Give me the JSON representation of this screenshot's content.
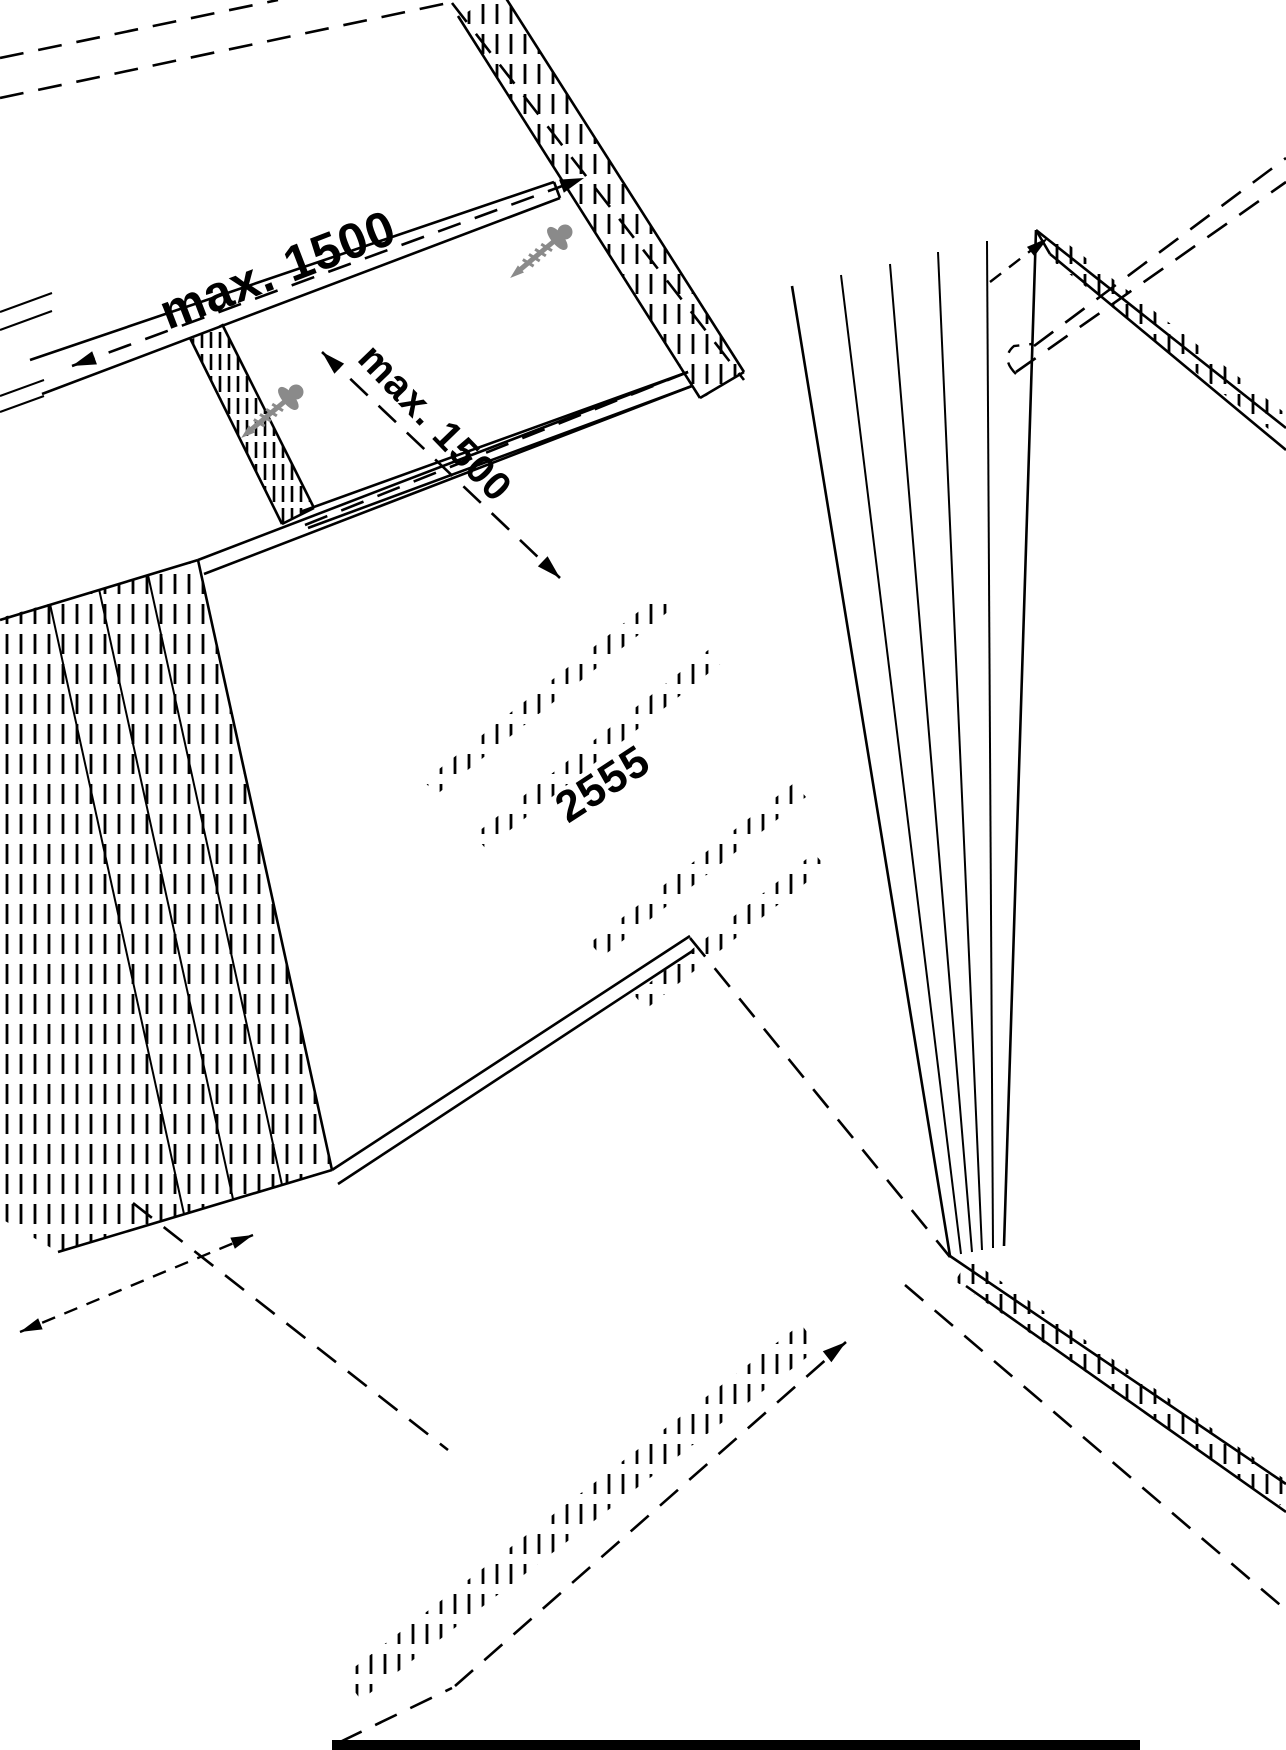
{
  "colors": {
    "background": "#ffffff",
    "line": "#000000",
    "screw_gray": "#8a8a8a"
  },
  "labels": {
    "dim_spacing_top": "max. 1500",
    "dim_spacing_mid": "max. 1500",
    "center_dim": "2555"
  },
  "icons": {
    "screw": "screw-icon",
    "dimension_arrow": "arrow-icon"
  }
}
